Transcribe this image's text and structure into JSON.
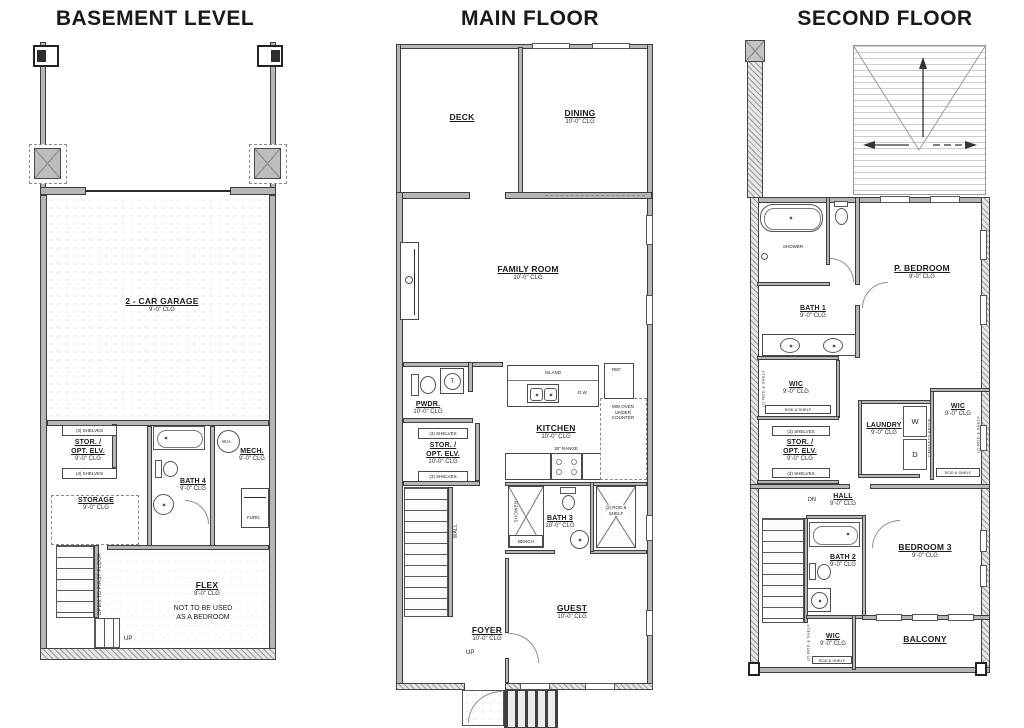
{
  "basement": {
    "title": "BASEMENT LEVEL",
    "garage": {
      "name": "2 - CAR GARAGE",
      "clg": "9'-0\" CLG"
    },
    "stor": {
      "l1": "STOR. /",
      "l2": "OPT. ELV.",
      "clg": "9'-0\" CLG"
    },
    "shelves": "(3) SHELVES",
    "bath4": {
      "name": "BATH 4",
      "clg": "9'-0\" CLG"
    },
    "mech": {
      "name": "MECH.",
      "clg": "9'-0\" CLG"
    },
    "wh": "W.H.",
    "furn": "FURN.",
    "storage": {
      "name": "STORAGE",
      "clg": "9'-0\" CLG"
    },
    "flex": {
      "name": "FLEX",
      "clg": "9'-0\" CLG",
      "note1": "NOT TO BE USED",
      "note2": "AS A BEDROOM"
    },
    "open_to": "OPEN TO FIRST FLOOR",
    "up": "UP"
  },
  "main": {
    "title": "MAIN FLOOR",
    "deck": {
      "name": "DECK"
    },
    "dining": {
      "name": "DINING",
      "clg": "10'-0\" CLG"
    },
    "family": {
      "name": "FAMILY ROOM",
      "clg": "10'-0\" CLG"
    },
    "kitchen": {
      "name": "KITCHEN",
      "clg": "10'-0\" CLG"
    },
    "island": "ISLAND",
    "dw": "D.W.",
    "range": "30\" RANGE",
    "ref": "REF.",
    "uc1": "MW OVEN",
    "uc2": "UNDER",
    "uc3": "COUNTER",
    "pwdr": {
      "name": "PWDR.",
      "clg": "10'-0\" CLG"
    },
    "stor": {
      "l1": "STOR. /",
      "l2": "OPT. ELV.",
      "clg": "10'-0\" CLG"
    },
    "shelves": "(3) SHELVES",
    "bath3": {
      "name": "BATH 3",
      "clg": "10'-0\" CLG"
    },
    "shower": "SHOWER",
    "bench": "BENCH",
    "closet1": "(2) ROD &",
    "closet2": "SHELF",
    "guest": {
      "name": "GUEST",
      "clg": "10'-0\" CLG"
    },
    "foyer": {
      "name": "FOYER",
      "clg": "10'-0\" CLG"
    },
    "up": "UP",
    "wall": "WALL"
  },
  "second": {
    "title": "SECOND FLOOR",
    "pbed": {
      "name": "P. BEDROOM",
      "clg": "9'-0\" CLG"
    },
    "bath1": {
      "name": "BATH 1",
      "clg": "9'-0\" CLG"
    },
    "shower": "SHOWER",
    "wic": "WIC",
    "clg9": "9'-0\" CLG",
    "rodshelf": "ROD & SHELF",
    "rodshelf2": "(2) ROD & SHELF",
    "stor": {
      "l1": "STOR. /",
      "l2": "OPT. ELV.",
      "clg": "9'-0\" CLG"
    },
    "shelves": "(3) SHELVES",
    "laundry": {
      "name": "LAUNDRY",
      "clg": "9'-0\" CLG",
      "w": "W",
      "d": "D",
      "cab": "CABINETS ABOVE"
    },
    "hall": {
      "name": "HALL",
      "clg": "9'-0\" CLG"
    },
    "bath2": {
      "name": "BATH 2",
      "clg": "9'-0\" CLG"
    },
    "bed3": {
      "name": "BEDROOM 3",
      "clg": "9'-0\" CLG"
    },
    "balcony": "BALCONY",
    "dn": "DN"
  }
}
